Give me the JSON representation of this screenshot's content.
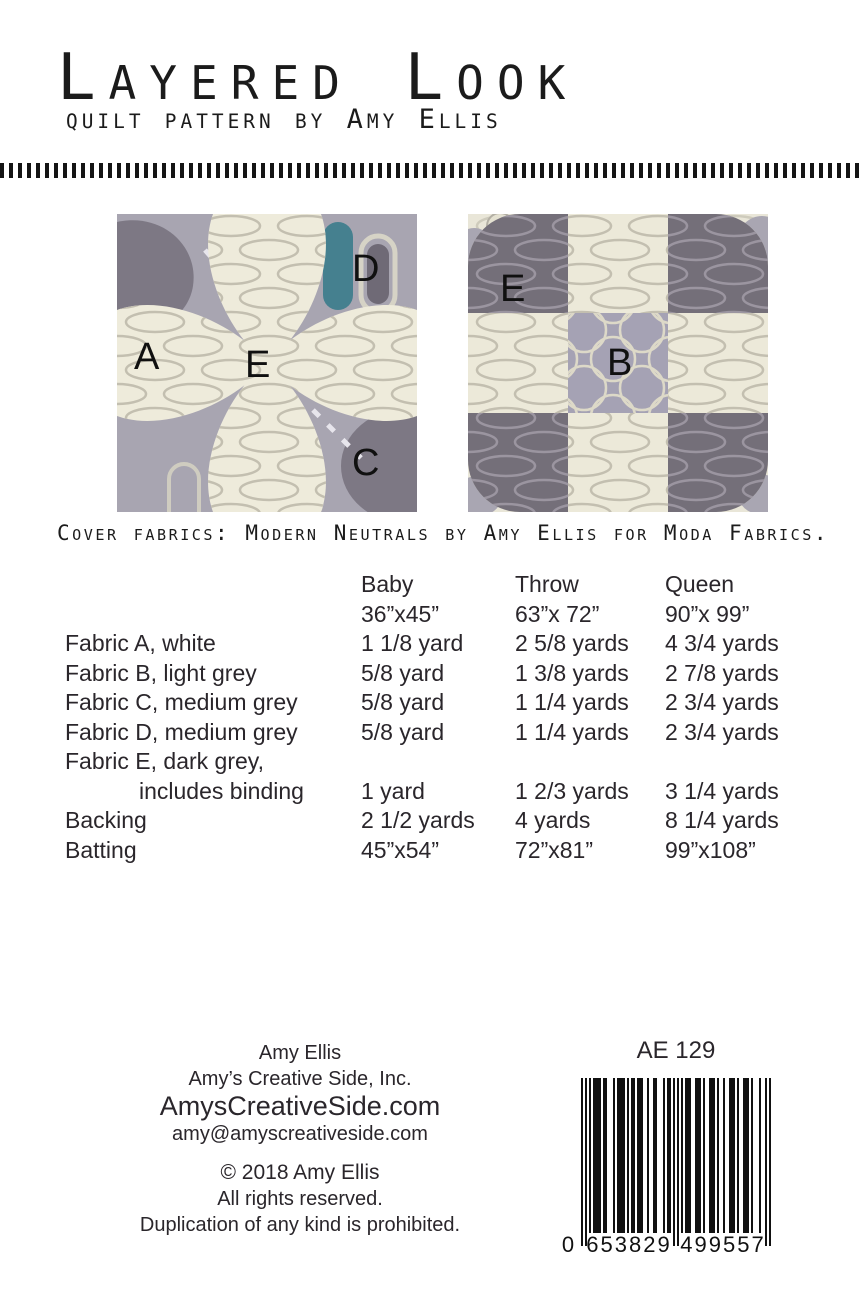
{
  "header": {
    "title": "Layered Look",
    "subtitle": "quilt pattern by Amy Ellis"
  },
  "cover": {
    "caption": "Cover fabrics: Modern Neutrals by Amy Ellis for Moda Fabrics.",
    "petal_block_labels": {
      "a": "A",
      "e": "E",
      "d": "D",
      "c": "C"
    },
    "patch_block_labels": {
      "e": "E",
      "b": "B"
    },
    "fabric_palette": {
      "white_cream": "#eeebdb",
      "light_grey": "#a5a2b4",
      "medium_grey": "#a8a5b1",
      "dark_grey": "#746f79",
      "teal_accent": "#45808f"
    }
  },
  "materials_table": {
    "columns": [
      {
        "name": "Baby",
        "size": "36”x45”"
      },
      {
        "name": "Throw",
        "size": "63”x 72”"
      },
      {
        "name": "Queen",
        "size": "90”x 99”"
      }
    ],
    "rows": [
      {
        "label": "Fabric A, white",
        "label2": "",
        "baby": "1 1/8 yard",
        "throw": "2 5/8 yards",
        "queen": "4 3/4 yards"
      },
      {
        "label": "Fabric B, light grey",
        "label2": "",
        "baby": "5/8 yard",
        "throw": "1 3/8 yards",
        "queen": "2 7/8 yards"
      },
      {
        "label": "Fabric C, medium grey",
        "label2": "",
        "baby": "5/8 yard",
        "throw": "1 1/4 yards",
        "queen": "2 3/4 yards"
      },
      {
        "label": "Fabric D, medium grey",
        "label2": "",
        "baby": "5/8 yard",
        "throw": "1 1/4 yards",
        "queen": "2 3/4 yards"
      },
      {
        "label": "Fabric E, dark grey,",
        "label2": "includes binding",
        "baby": "1 yard",
        "throw": "1 2/3 yards",
        "queen": "3 1/4 yards"
      },
      {
        "label": "Backing",
        "label2": "",
        "baby": "2 1/2 yards",
        "throw": "4 yards",
        "queen": "8 1/4 yards"
      },
      {
        "label": "Batting",
        "label2": "",
        "baby": "45”x54”",
        "throw": "72”x81”",
        "queen": "99”x108”"
      }
    ]
  },
  "footer": {
    "author": "Amy Ellis",
    "company": "Amy’s Creative Side, Inc.",
    "website": "AmysCreativeSide.com",
    "email": "amy@amyscreativeside.com",
    "copyright": "©  2018 Amy Ellis",
    "rights": "All rights reserved.",
    "duplication": "Duplication of any kind is prohibited."
  },
  "product": {
    "code": "AE 129",
    "barcode_digits": "0653829499557",
    "barcode_display": {
      "lead": "0",
      "left": "653829",
      "right": "499557"
    }
  }
}
